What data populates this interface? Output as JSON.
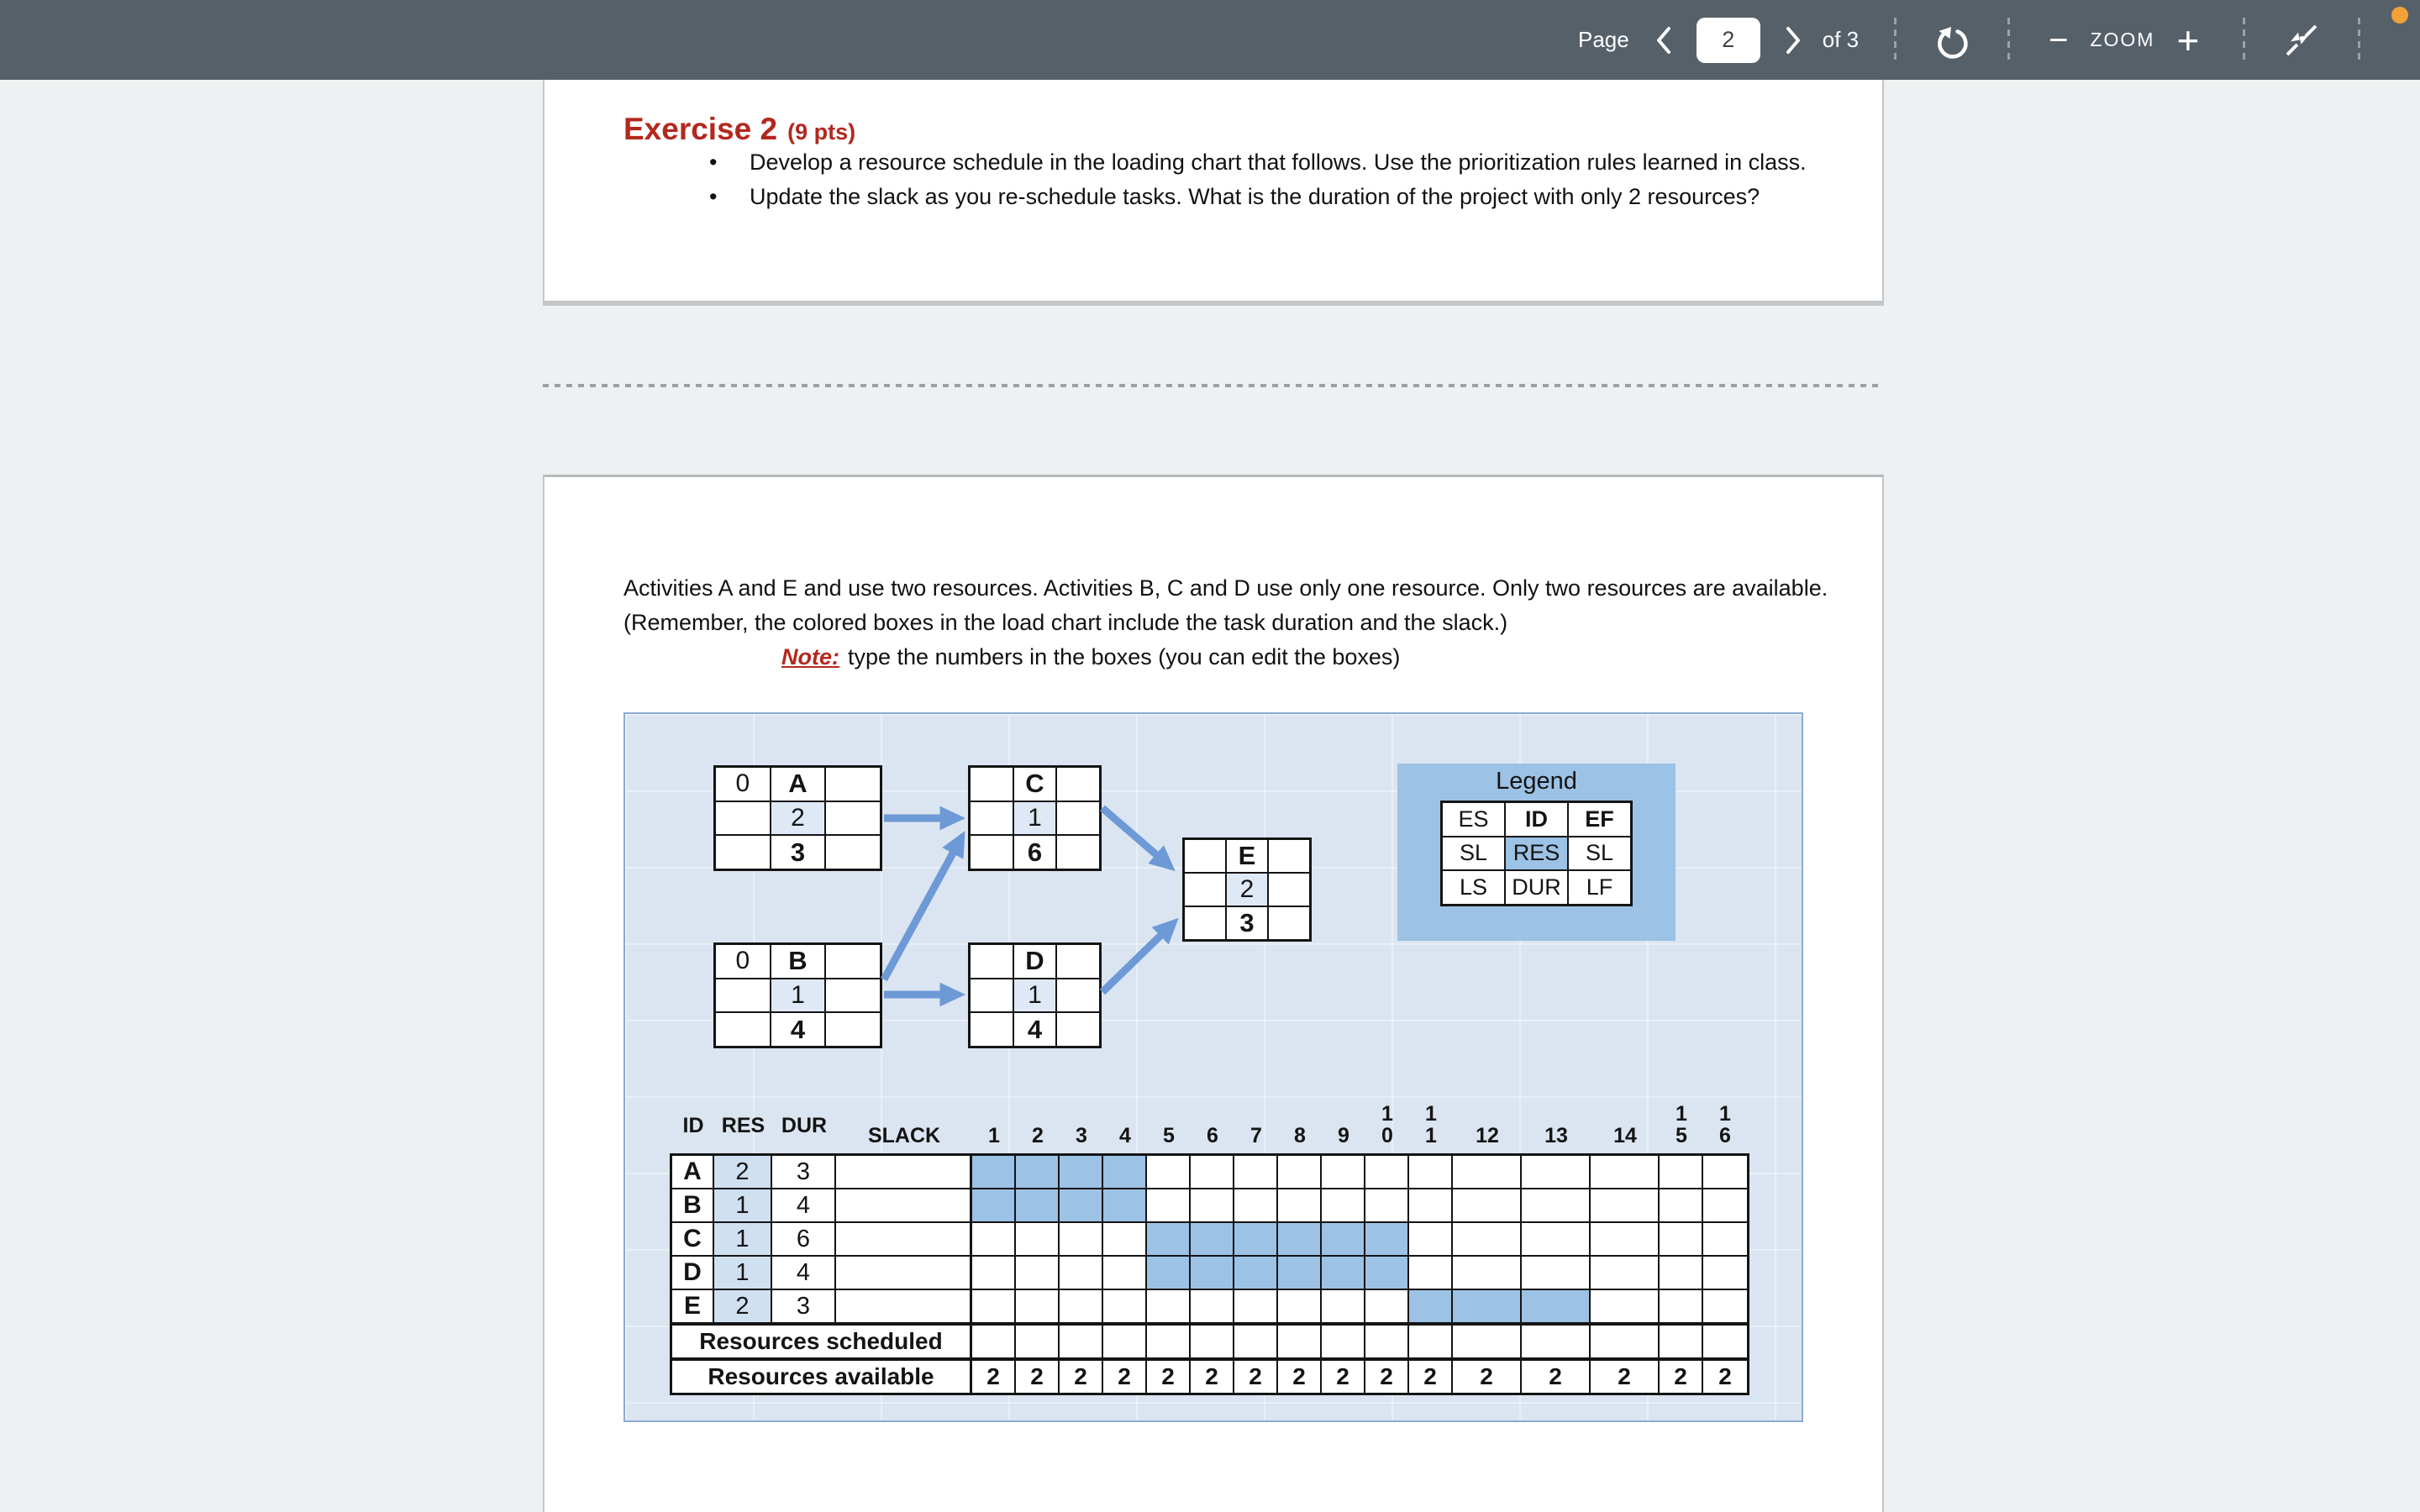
{
  "toolbar": {
    "page_label": "Page",
    "page_value": "2",
    "of_label": "of 3",
    "zoom_label": "ZOOM"
  },
  "page1": {
    "title": "Exercise 2",
    "points": "(9 pts)",
    "bullets": [
      "Develop a resource schedule in the loading chart that follows. Use the prioritization rules learned in class.",
      "Update the slack as you re-schedule tasks. What is the duration of the project with only 2 resources?"
    ]
  },
  "page2": {
    "line1": "Activities A and E and use two resources. Activities B, C and D use only one resource. Only two resources are available.",
    "line2": "(Remember, the colored boxes in the load chart include the task duration and the slack.)",
    "note_label": "Note:",
    "note_text": "type the numbers in the boxes (you can edit the boxes)"
  },
  "diagram": {
    "nodes": [
      {
        "id": "A",
        "cells": [
          [
            "0",
            "A",
            ""
          ],
          [
            "",
            "2",
            ""
          ],
          [
            "",
            "3",
            ""
          ]
        ]
      },
      {
        "id": "B",
        "cells": [
          [
            "0",
            "B",
            ""
          ],
          [
            "",
            "1",
            ""
          ],
          [
            "",
            "4",
            ""
          ]
        ]
      },
      {
        "id": "C",
        "cells": [
          [
            "",
            "C",
            ""
          ],
          [
            "",
            "1",
            ""
          ],
          [
            "",
            "6",
            ""
          ]
        ]
      },
      {
        "id": "D",
        "cells": [
          [
            "",
            "D",
            ""
          ],
          [
            "",
            "1",
            ""
          ],
          [
            "",
            "4",
            ""
          ]
        ]
      },
      {
        "id": "E",
        "cells": [
          [
            "",
            "E",
            ""
          ],
          [
            "",
            "2",
            ""
          ],
          [
            "",
            "3",
            ""
          ]
        ]
      }
    ],
    "edges": [
      [
        "A",
        "C"
      ],
      [
        "B",
        "C"
      ],
      [
        "B",
        "D"
      ],
      [
        "C",
        "E"
      ],
      [
        "D",
        "E"
      ]
    ],
    "legend": {
      "title": "Legend",
      "rows": [
        [
          "ES",
          "ID",
          "EF"
        ],
        [
          "SL",
          "RES",
          "SL"
        ],
        [
          "LS",
          "DUR",
          "LF"
        ]
      ],
      "bold_cells": [
        "ID",
        "EF"
      ],
      "shaded_cell": "RES"
    }
  },
  "load_chart": {
    "columns": {
      "id": "ID",
      "res": "RES",
      "dur": "DUR",
      "slack": "SLACK"
    },
    "periods": [
      "1",
      "2",
      "3",
      "4",
      "5",
      "6",
      "7",
      "8",
      "9",
      "10",
      "11",
      "12",
      "13",
      "14",
      "15",
      "16"
    ],
    "rows": [
      {
        "id": "A",
        "res": "2",
        "dur": "3",
        "slack": "",
        "bar": [
          1,
          4
        ]
      },
      {
        "id": "B",
        "res": "1",
        "dur": "4",
        "slack": "",
        "bar": [
          1,
          4
        ]
      },
      {
        "id": "C",
        "res": "1",
        "dur": "6",
        "slack": "",
        "bar": [
          5,
          10
        ]
      },
      {
        "id": "D",
        "res": "1",
        "dur": "4",
        "slack": "",
        "bar": [
          5,
          10
        ]
      },
      {
        "id": "E",
        "res": "2",
        "dur": "3",
        "slack": "",
        "bar": [
          11,
          13
        ]
      }
    ],
    "scheduled_label": "Resources scheduled",
    "available_label": "Resources available",
    "scheduled": [
      "",
      "",
      "",
      "",
      "",
      "",
      "",
      "",
      "",
      "",
      "",
      "",
      "",
      "",
      "",
      ""
    ],
    "available": [
      "2",
      "2",
      "2",
      "2",
      "2",
      "2",
      "2",
      "2",
      "2",
      "2",
      "2",
      "2",
      "2",
      "2",
      "2",
      "2"
    ]
  },
  "colors": {
    "toolbar_bg": "#566069",
    "accent_red": "#b3281e",
    "canvas_bg": "#dbe5f1",
    "bar_fill": "#9cc2e5",
    "node_fill": "#dfe9f6",
    "res_col_fill": "#cfe0f1",
    "arrow": "#6d9ad6",
    "record_dot": "#f0a137"
  }
}
